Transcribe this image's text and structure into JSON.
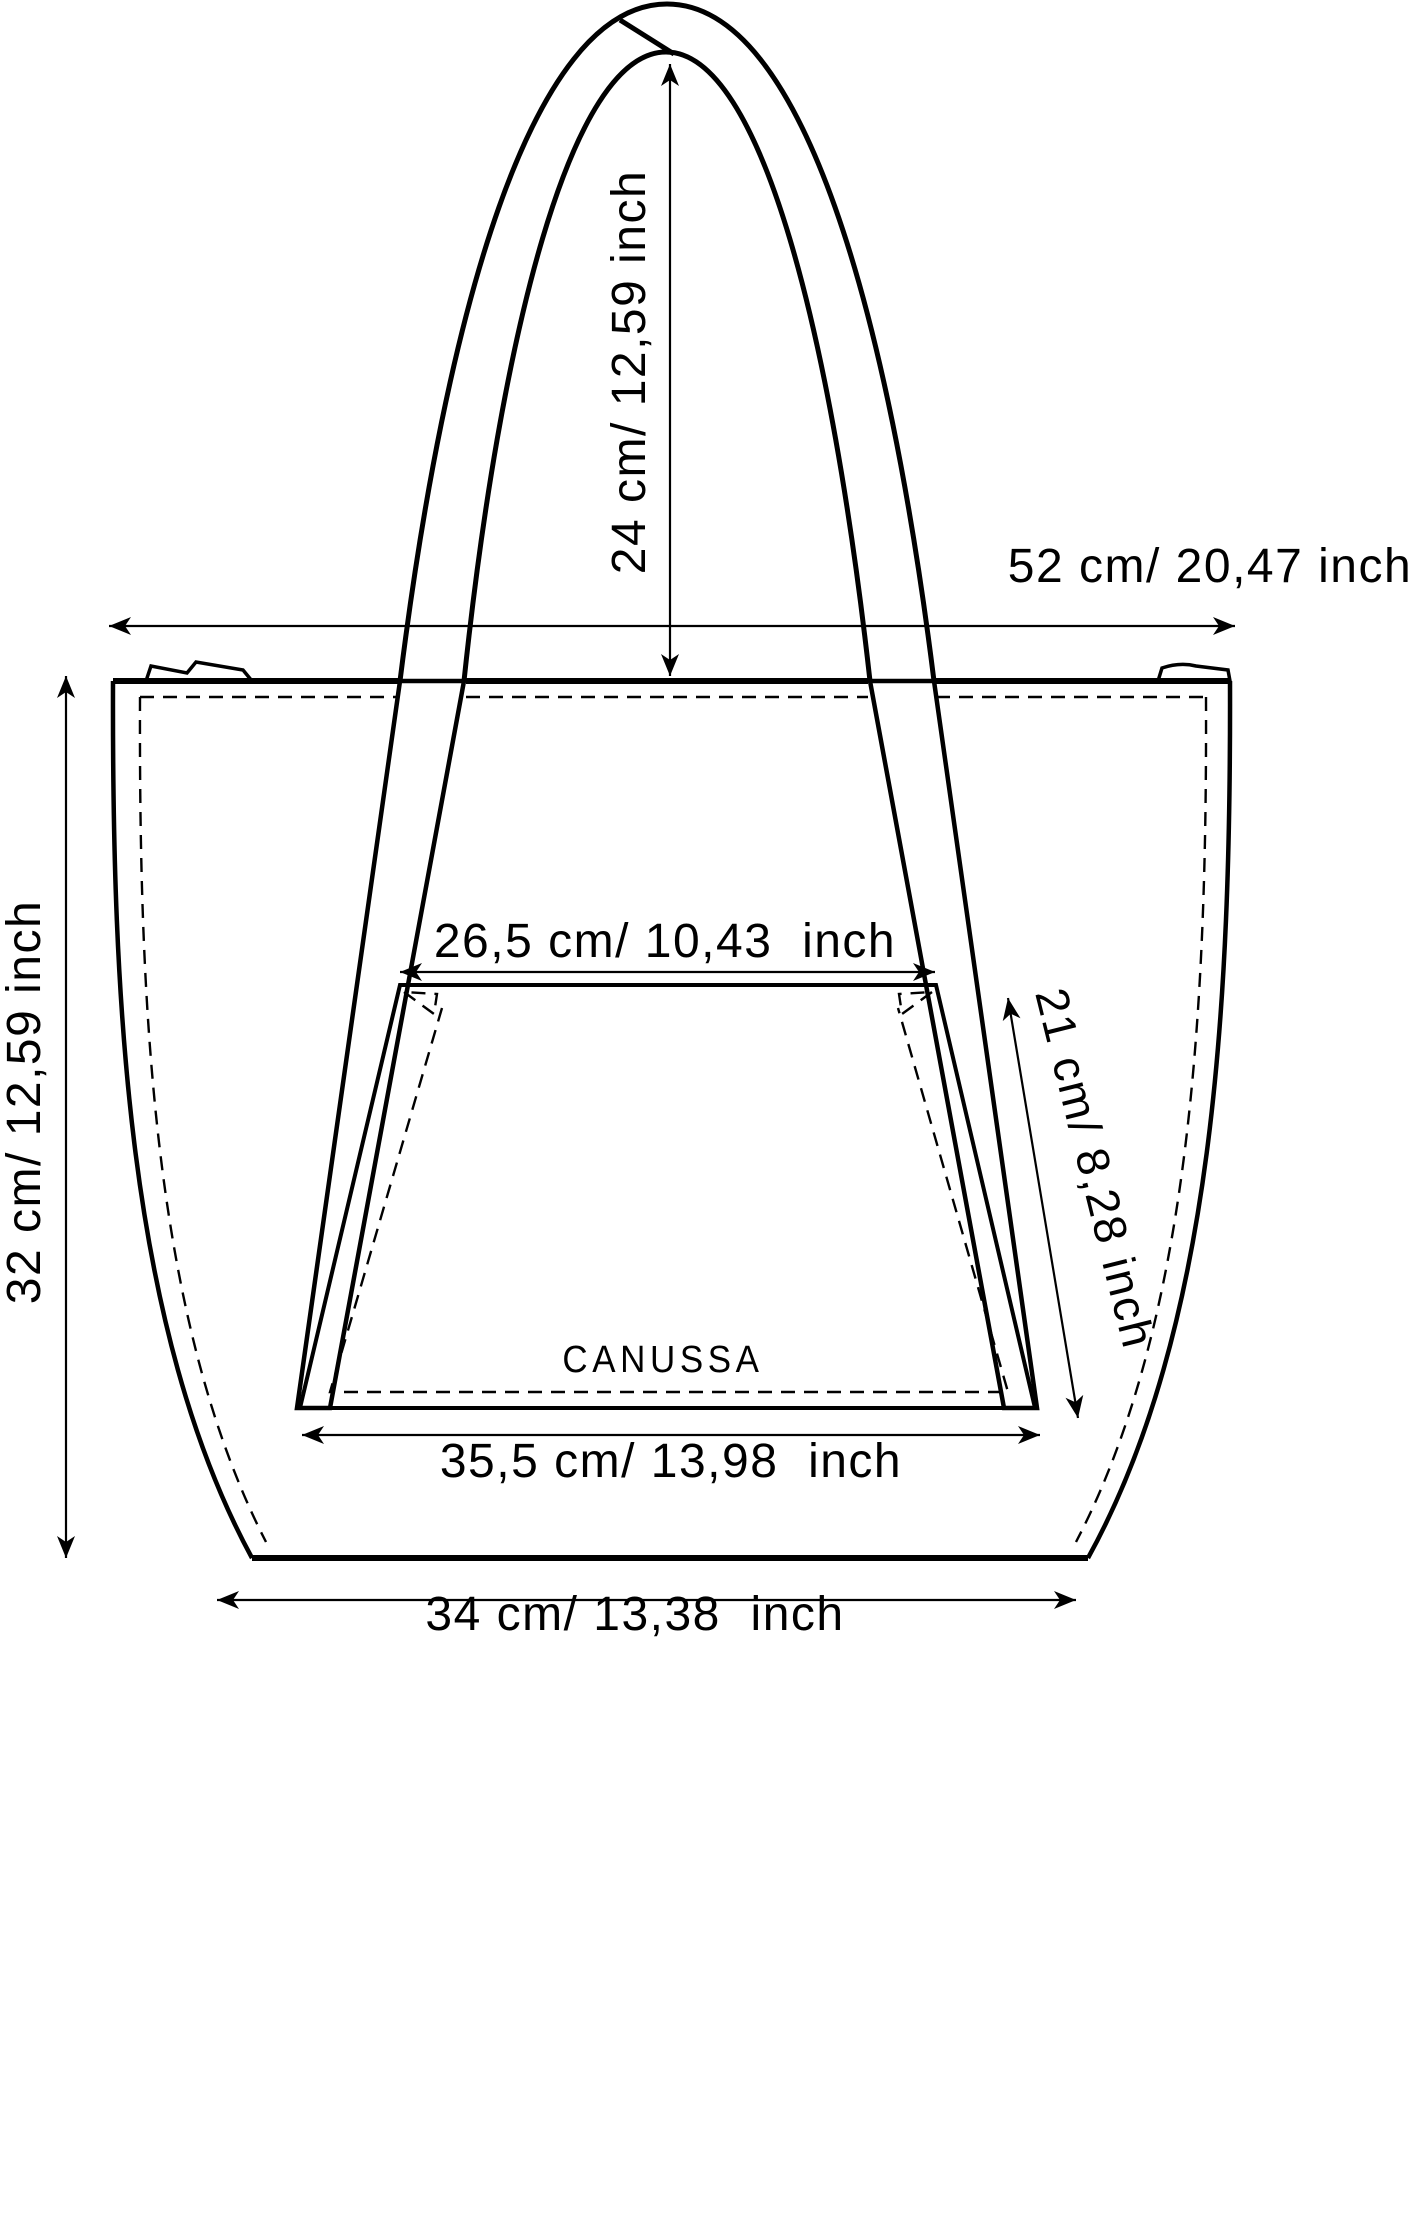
{
  "page": {
    "background": "#ffffff",
    "line_color": "#000000"
  },
  "diagram": {
    "brand": "CANUSSA",
    "labels": {
      "handle_height": "24 cm/ 12,59 inch",
      "top_width": "52 cm/ 20,47 inch",
      "side_height": "32 cm/ 12,59 inch",
      "pocket_top_width": "26,5 cm/ 10,43  inch",
      "strap_panel_length": "21 cm/ 8,28 inch",
      "pocket_bottom_width": "35,5 cm/ 13,98  inch",
      "base_width": "34 cm/ 13,38  inch"
    }
  }
}
